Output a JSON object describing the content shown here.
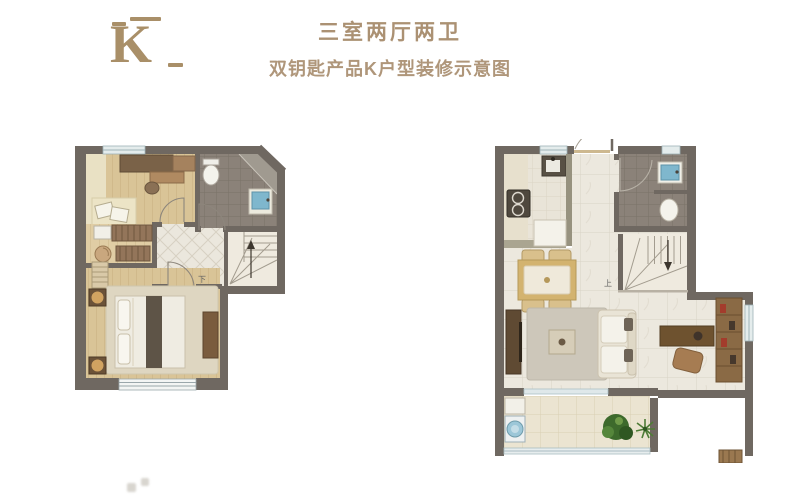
{
  "header": {
    "logo_letter": "K",
    "title": "三室两厅两卫",
    "subtitle": "双钥匙产品K户型装修示意图"
  },
  "plans": {
    "left": {
      "stairs_label": "下"
    },
    "right": {
      "stairs_label": "上"
    }
  },
  "palette": {
    "accent_text": "#ab9173",
    "logo_gold": "#a98f68",
    "wall": "#6f6861",
    "wood_floor": "#d9c497",
    "light_wood_floor": "#e2d1aa",
    "marble_floor": "#ece8de",
    "bath_tile": "#8b8279",
    "stair_fill": "#efeadf",
    "window_glass": "#dfe9ea",
    "fixture_blue": "#7fb7cd",
    "table_gold": "#d3b36f",
    "sofa_cream": "#e9e4d6",
    "bed_runner": "#5e5447",
    "plant_green": "#4e7c36",
    "washer_blue": "#9cc7d8"
  }
}
